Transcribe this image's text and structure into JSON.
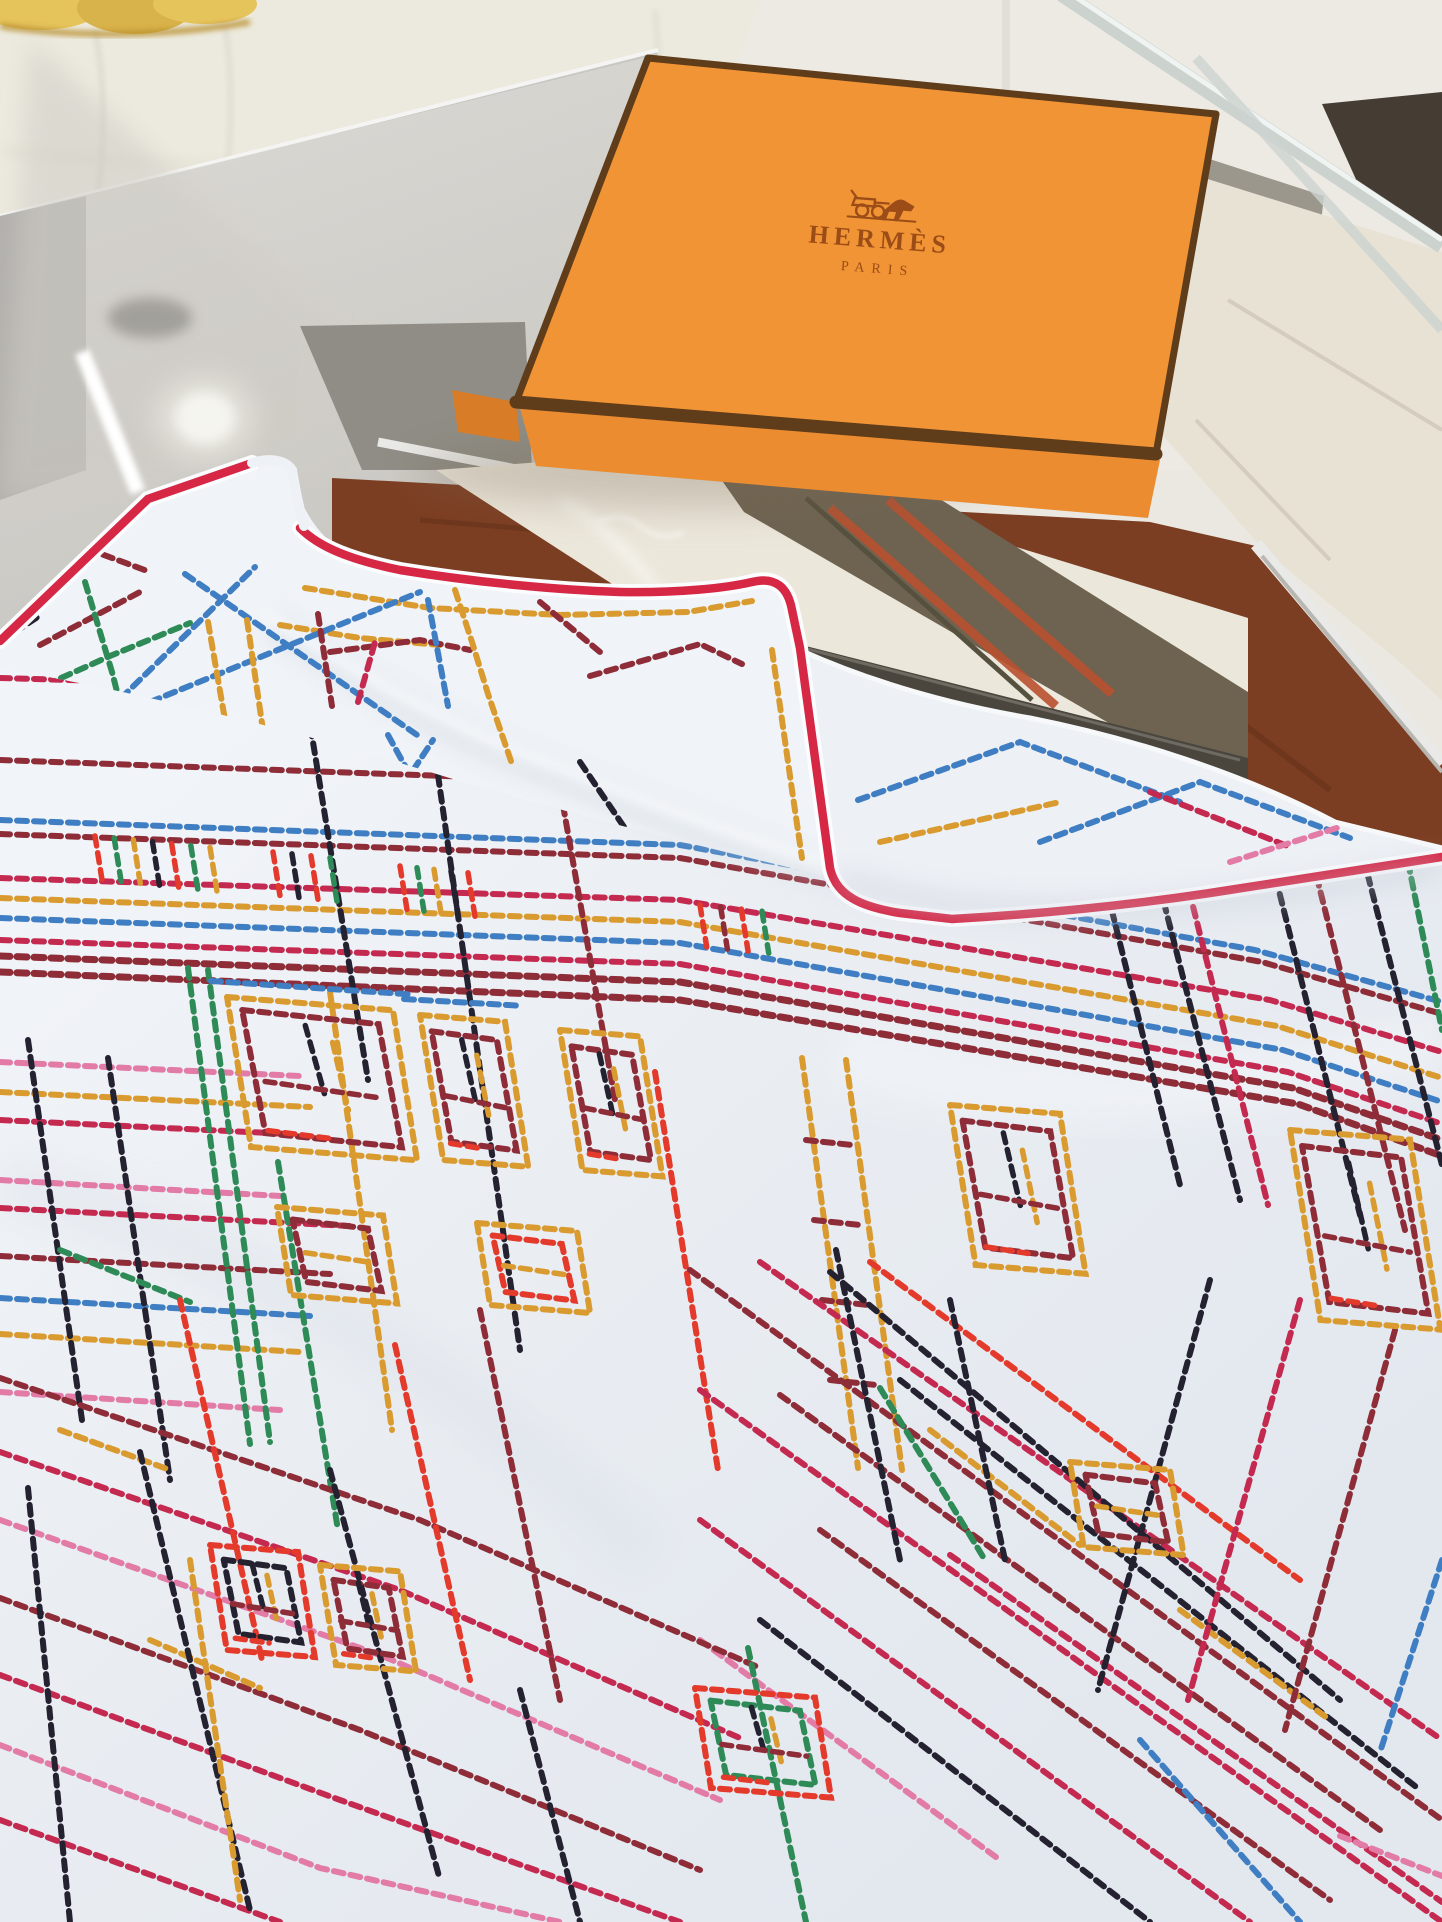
{
  "box": {
    "brand": "HERMÈS",
    "city": "PARIS",
    "logo_icon": "horse-carriage-icon"
  },
  "palette": {
    "bg": "#ebe8e2",
    "sofa": "#eceade",
    "sofa_seam": "#dcd8cd",
    "plush": "#e6c45c",
    "plush2": "#d8b24a",
    "chrome": "#c7c7c4",
    "chrome_hi": "#f4f4f2",
    "glass_strip": "#ccd3cf",
    "dark_wedge": "#453c34",
    "column": "#9c978d",
    "column_hi": "#b8b3a9",
    "tile": "#e8e2d4",
    "tile_line": "#d4cdbd",
    "glass_face": "#d7d5d0",
    "glass_left": "#aeaca7",
    "glass_smudge": "#8f8d88",
    "graywall": "#8f8d85",
    "silver": "#e9e9e7",
    "wood": "#7c3e22",
    "wood_dark": "#5e2d17",
    "panel": "#ece7db",
    "slab": "#6e6351",
    "slab_dark": "#56503e",
    "slab_stripe": "#b8502f",
    "frame": "#4a463e",
    "frame_hi": "#6e6a62",
    "box_top": "#f09435",
    "box_side": "#d87c28",
    "box_base": "#eb8c30",
    "box_trim": "#5f3c1a",
    "logo": "#9c4c16",
    "scarf": "#e9edf2",
    "flap": "#f0f3f7",
    "corner_layer": "#edf0f5",
    "hem": "#d62745",
    "stitch": {
      "cr": "#c42950",
      "ma": "#8e2d38",
      "rd": "#e33a2c",
      "go": "#d99b2f",
      "bl": "#3f7ec2",
      "gr": "#2e8a57",
      "bk": "#242230",
      "pk": "#e27ba6"
    }
  },
  "scarf_pattern": {
    "main": [
      [
        "cr",
        [
          0,
          678,
          480,
          692
        ]
      ],
      [
        "ma",
        [
          0,
          760,
          500,
          778
        ]
      ],
      [
        "bl",
        [
          0,
          820,
          680,
          845,
          1255,
          950,
          1442,
          1002
        ]
      ],
      [
        "ma",
        [
          0,
          834,
          680,
          858,
          1262,
          962,
          1442,
          1014
        ]
      ],
      [
        "cr",
        [
          0,
          878,
          680,
          900,
          1270,
          1000,
          1442,
          1052
        ]
      ],
      [
        "go",
        [
          0,
          898,
          680,
          922,
          1277,
          1026,
          1442,
          1078
        ]
      ],
      [
        "bl",
        [
          0,
          918,
          680,
          943,
          1283,
          1050,
          1442,
          1102
        ]
      ],
      [
        "cr",
        [
          0,
          940,
          680,
          964,
          1288,
          1072,
          1442,
          1124
        ]
      ],
      [
        "ma",
        7,
        [
          0,
          956,
          680,
          982,
          1293,
          1088,
          1442,
          1140
        ]
      ],
      [
        "ma",
        7,
        [
          0,
          972,
          680,
          1000,
          1298,
          1104,
          1442,
          1156
        ]
      ],
      [
        "pk",
        [
          0,
          1062,
          300,
          1076
        ]
      ],
      [
        "go",
        [
          0,
          1092,
          310,
          1107
        ]
      ],
      [
        "cr",
        [
          0,
          1120,
          290,
          1134
        ]
      ],
      [
        "pk",
        [
          0,
          1180,
          280,
          1196
        ]
      ],
      [
        "cr",
        [
          0,
          1208,
          350,
          1226
        ]
      ],
      [
        "ma",
        [
          0,
          1256,
          330,
          1274
        ]
      ],
      [
        "bl",
        [
          0,
          1298,
          310,
          1316
        ]
      ],
      [
        "go",
        [
          0,
          1334,
          300,
          1352
        ]
      ],
      [
        "pk",
        [
          0,
          1392,
          280,
          1410
        ]
      ],
      [
        "go",
        [
          802,
          1058,
          858,
          1468
        ]
      ],
      [
        "go",
        [
          846,
          1060,
          902,
          1470
        ]
      ],
      [
        "ma",
        [
          806,
          1140,
          852,
          1145
        ]
      ],
      [
        "ma",
        [
          814,
          1220,
          860,
          1225
        ]
      ],
      [
        "ma",
        [
          822,
          1300,
          868,
          1305
        ]
      ],
      [
        "ma",
        [
          830,
          1380,
          876,
          1385
        ]
      ],
      [
        "bk",
        [
          28,
          1040,
          82,
          1420
        ]
      ],
      [
        "bk",
        [
          108,
          1058,
          170,
          1480
        ]
      ],
      [
        "gr",
        [
          188,
          968,
          250,
          1444
        ]
      ],
      [
        "gr",
        [
          208,
          970,
          270,
          1442
        ]
      ],
      [
        "go",
        [
          330,
          992,
          392,
          1430
        ]
      ],
      [
        "gr",
        [
          278,
          1162,
          338,
          1530
        ]
      ],
      [
        "bk",
        [
          305,
          693,
          368,
          1080
        ]
      ],
      [
        "bk",
        [
          438,
          775,
          520,
          1350
        ]
      ],
      [
        "ma",
        [
          560,
          788,
          615,
          1100
        ]
      ],
      [
        "rd",
        [
          655,
          1072,
          718,
          1470
        ]
      ],
      [
        "bk",
        [
          1075,
          762,
          1180,
          1185
        ]
      ],
      [
        "bk",
        [
          1130,
          770,
          1240,
          1200
        ]
      ],
      [
        "cr",
        [
          1160,
          775,
          1268,
          1205
        ]
      ],
      [
        "bk",
        [
          1255,
          795,
          1360,
          1215
        ]
      ],
      [
        "ma",
        [
          1300,
          810,
          1405,
          1230
        ]
      ],
      [
        "bk",
        [
          1355,
          825,
          1442,
          1165
        ]
      ],
      [
        "gr",
        [
          1408,
          862,
          1442,
          1030
        ]
      ],
      [
        "ma",
        [
          690,
          1270,
          1442,
          1820
        ]
      ],
      [
        "cr",
        [
          760,
          1262,
          1442,
          1740
        ]
      ],
      [
        "bk",
        [
          830,
          1272,
          1340,
          1700
        ]
      ],
      [
        "cr",
        [
          700,
          1390,
          1442,
          1922
        ]
      ],
      [
        "ma",
        [
          780,
          1395,
          1380,
          1830
        ]
      ],
      [
        "bk",
        [
          900,
          1380,
          1420,
          1790
        ]
      ],
      [
        "cr",
        [
          700,
          1520,
          1250,
          1922
        ]
      ],
      [
        "ma",
        [
          820,
          1530,
          1330,
          1900
        ]
      ],
      [
        "cr",
        [
          950,
          1555,
          1442,
          1902
        ]
      ],
      [
        "bk",
        [
          760,
          1620,
          1150,
          1922
        ]
      ],
      [
        "rd",
        [
          870,
          1262,
          1300,
          1580
        ]
      ],
      [
        "go",
        [
          930,
          1430,
          1080,
          1545
        ]
      ],
      [
        "go",
        [
          1180,
          1610,
          1330,
          1720
        ]
      ],
      [
        "bl",
        [
          1140,
          1740,
          1300,
          1922
        ]
      ],
      [
        "gr",
        [
          880,
          1388,
          985,
          1560
        ]
      ],
      [
        "pk",
        [
          700,
          1640,
          1000,
          1860
        ]
      ],
      [
        "bk",
        [
          1210,
          1280,
          1098,
          1690
        ]
      ],
      [
        "cr",
        [
          1300,
          1300,
          1188,
          1700
        ]
      ],
      [
        "ma",
        [
          1395,
          1330,
          1285,
          1730
        ]
      ],
      [
        "bl",
        [
          1442,
          1560,
          1380,
          1752
        ]
      ],
      [
        "ma",
        [
          0,
          1378,
          420,
          1520,
          760,
          1668
        ]
      ],
      [
        "cr",
        [
          0,
          1452,
          400,
          1590,
          740,
          1738
        ]
      ],
      [
        "pk",
        [
          0,
          1520,
          380,
          1655,
          720,
          1800
        ]
      ],
      [
        "ma",
        [
          0,
          1598,
          360,
          1730,
          700,
          1870
        ]
      ],
      [
        "cr",
        [
          0,
          1675,
          340,
          1800,
          680,
          1922
        ]
      ],
      [
        "pk",
        [
          0,
          1745,
          320,
          1868,
          560,
          1922
        ]
      ],
      [
        "cr",
        [
          0,
          1820,
          280,
          1922
        ]
      ],
      [
        "go",
        [
          60,
          1430,
          170,
          1470
        ]
      ],
      [
        "go",
        [
          150,
          1640,
          260,
          1688
        ]
      ],
      [
        "gr",
        [
          60,
          1250,
          190,
          1302
        ]
      ],
      [
        "bk",
        [
          28,
          1488,
          70,
          1922
        ]
      ],
      [
        "bk",
        [
          140,
          1452,
          250,
          1910
        ]
      ],
      [
        "rd",
        [
          180,
          1300,
          262,
          1660
        ]
      ],
      [
        "bk",
        [
          330,
          1470,
          440,
          1880
        ]
      ],
      [
        "rd",
        [
          395,
          1345,
          470,
          1680
        ]
      ],
      [
        "go",
        [
          190,
          1560,
          240,
          1900
        ]
      ],
      [
        "ma",
        [
          480,
          1310,
          560,
          1700
        ]
      ],
      [
        "bk",
        [
          520,
          1690,
          580,
          1922
        ]
      ],
      [
        "gr",
        [
          748,
          1648,
          806,
          1922
        ]
      ],
      [
        "bk",
        [
          836,
          1250,
          900,
          1560
        ]
      ],
      [
        "bk",
        [
          950,
          1300,
          1005,
          1560
        ]
      ],
      [
        "pk",
        [
          1340,
          1836,
          1442,
          1876
        ]
      ]
    ],
    "flap": [
      [
        "go",
        [
          20,
          620,
          150,
          500,
          258,
          464
        ]
      ],
      [
        "go",
        [
          305,
          588,
          430,
          608,
          560,
          615,
          688,
          612,
          752,
          601
        ]
      ],
      [
        "go",
        [
          280,
          625,
          360,
          638,
          440,
          645
        ]
      ],
      [
        "ma",
        [
          330,
          652,
          420,
          640,
          470,
          650
        ]
      ],
      [
        "go",
        [
          772,
          650,
          782,
          720,
          792,
          790,
          802,
          858
        ]
      ],
      [
        "ma",
        [
          0,
          600,
          85,
          548,
          150,
          572
        ]
      ],
      [
        "ma",
        [
          40,
          645,
          140,
          592
        ]
      ],
      [
        "gr",
        [
          85,
          582,
          112,
          672,
          135,
          762
        ]
      ],
      [
        "gr",
        [
          30,
          692,
          110,
          656,
          190,
          623
        ]
      ],
      [
        "bl",
        [
          60,
          758,
          255,
          567
        ]
      ],
      [
        "bl",
        [
          185,
          574,
          420,
          737
        ]
      ],
      [
        "bl",
        [
          150,
          702,
          420,
          592
        ]
      ],
      [
        "go",
        [
          208,
          622,
          232,
          760
        ]
      ],
      [
        "go",
        [
          247,
          620,
          274,
          806
        ]
      ],
      [
        "bl",
        [
          388,
          735,
          410,
          775,
          433,
          740
        ]
      ],
      [
        "go",
        [
          455,
          590,
          472,
          642,
          488,
          694,
          512,
          764
        ]
      ],
      [
        "ma",
        [
          590,
          676,
          700,
          644,
          742,
          664
        ]
      ],
      [
        "bk",
        [
          0,
          602,
          32,
          582
        ]
      ],
      [
        "bk",
        [
          0,
          642,
          42,
          614
        ]
      ],
      [
        "bl",
        [
          30,
          696,
          82,
          727
        ]
      ],
      [
        "bl",
        [
          428,
          600,
          448,
          706
        ]
      ],
      [
        "ma",
        [
          318,
          614,
          332,
          706
        ]
      ],
      [
        "cr",
        [
          358,
          702,
          375,
          642
        ]
      ],
      [
        "ma",
        [
          540,
          602,
          600,
          652
        ]
      ],
      [
        "bk",
        [
          580,
          762,
          660,
          880
        ]
      ]
    ],
    "corner": [
      [
        "bl",
        [
          858,
          800,
          1020,
          742,
          1180,
          802
        ]
      ],
      [
        "bl",
        [
          1040,
          842,
          1200,
          782,
          1350,
          838
        ]
      ],
      [
        "cr",
        [
          1150,
          792,
          1290,
          847
        ]
      ],
      [
        "go",
        [
          880,
          842,
          1060,
          802
        ]
      ],
      [
        "pk",
        [
          1230,
          862,
          1340,
          827
        ]
      ]
    ],
    "windows": [
      {
        "x": 227,
        "y": 997,
        "w": 166,
        "h": 150,
        "layers": [
          "bl",
          "go",
          "ma"
        ]
      },
      {
        "x": 420,
        "y": 1015,
        "w": 85,
        "h": 145,
        "layers": [
          "bl",
          "go",
          "ma"
        ]
      },
      {
        "x": 560,
        "y": 1030,
        "w": 80,
        "h": 140,
        "layers": [
          "go",
          "ma"
        ]
      },
      {
        "x": 950,
        "y": 1105,
        "w": 110,
        "h": 160,
        "layers": [
          "go",
          "ma"
        ]
      },
      {
        "x": 1290,
        "y": 1130,
        "w": 120,
        "h": 190,
        "layers": [
          "go",
          "ma"
        ]
      },
      {
        "x": 277,
        "y": 1207,
        "w": 106,
        "h": 88,
        "layers": [
          "go",
          "ma"
        ]
      },
      {
        "x": 477,
        "y": 1223,
        "w": 100,
        "h": 82,
        "layers": [
          "go",
          "rd"
        ]
      },
      {
        "x": 210,
        "y": 1545,
        "w": 88,
        "h": 105,
        "layers": [
          "rd",
          "bk"
        ]
      },
      {
        "x": 320,
        "y": 1565,
        "w": 80,
        "h": 100,
        "layers": [
          "go",
          "ma"
        ]
      },
      {
        "x": 695,
        "y": 1688,
        "w": 120,
        "h": 100,
        "layers": [
          "rd",
          "gr"
        ]
      },
      {
        "x": 1070,
        "y": 1462,
        "w": 100,
        "h": 85,
        "layers": [
          "go",
          "ma"
        ]
      }
    ],
    "dentils": [
      {
        "x0": 95,
        "x1": 210,
        "y": 836,
        "slope": 0.1,
        "len": 46,
        "n": 7,
        "colors": [
          "rd",
          "gr",
          "go",
          "bk",
          "rd",
          "gr",
          "go"
        ]
      },
      {
        "x0": 273,
        "x1": 330,
        "y": 852,
        "slope": 0.1,
        "len": 44,
        "n": 4,
        "colors": [
          "rd",
          "bk",
          "rd",
          "gr"
        ]
      },
      {
        "x0": 400,
        "x1": 468,
        "y": 866,
        "slope": 0.1,
        "len": 44,
        "n": 5,
        "colors": [
          "rd",
          "gr",
          "go",
          "bk",
          "rd"
        ]
      },
      {
        "x0": 700,
        "x1": 762,
        "y": 905,
        "slope": 0.1,
        "len": 42,
        "n": 4,
        "colors": [
          "rd",
          "ma",
          "rd",
          "gr"
        ]
      },
      {
        "x0": 1090,
        "x1": 1175,
        "y": 795,
        "slope": 0.12,
        "len": 44,
        "n": 5,
        "colors": [
          "rd",
          "gr",
          "rd",
          "go",
          "bk"
        ]
      }
    ]
  }
}
